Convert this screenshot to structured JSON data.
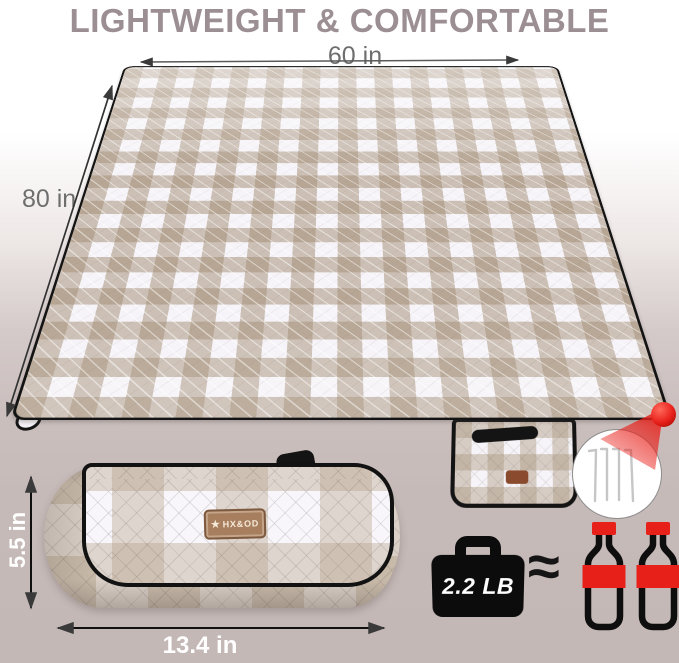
{
  "title": {
    "text": "LIGHTWEIGHT & COMFORTABLE"
  },
  "blanket": {
    "width_label": "60 in",
    "length_label": "80 in"
  },
  "roll": {
    "height_label": "5.5 in",
    "width_label": "13.4 in",
    "brand_star": "★",
    "brand": "HX&OD"
  },
  "weight": {
    "value": "2.2 LB",
    "approx": "≈"
  },
  "callout": {
    "stakes_count": 4,
    "bottles_count": 2
  },
  "colors": {
    "title_text": "#9c8f93",
    "dimension_text": "#6e6e6e",
    "background_bottom": "#c4b8b6",
    "gingham_tan": "#a38d74",
    "accent_red": "#e8201a",
    "label_brown": "#a87f5e",
    "binding_black": "#141414"
  }
}
